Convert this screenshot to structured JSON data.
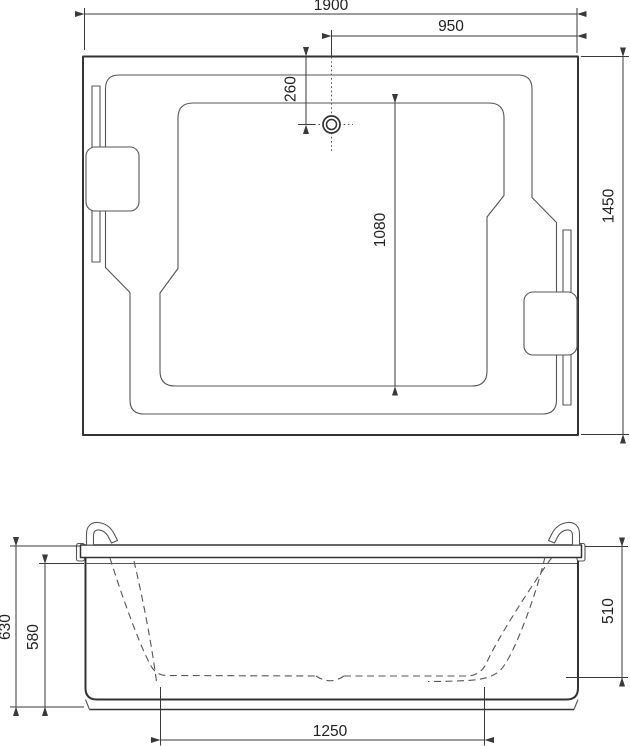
{
  "colors": {
    "bg": "#ffffff",
    "line": "#333333",
    "thin": "#555555",
    "dim": "#3a3a3a",
    "text": "#222222"
  },
  "top_view": {
    "dims": {
      "overall_width": "1900",
      "drain_to_right_edge": "950",
      "drain_from_top_edge": "260",
      "basin_inner_length": "1080",
      "overall_depth": "1450"
    }
  },
  "front_view": {
    "dims": {
      "total_height": "630",
      "shell_height": "580",
      "inner_depth": "510",
      "base_length": "1250"
    }
  }
}
